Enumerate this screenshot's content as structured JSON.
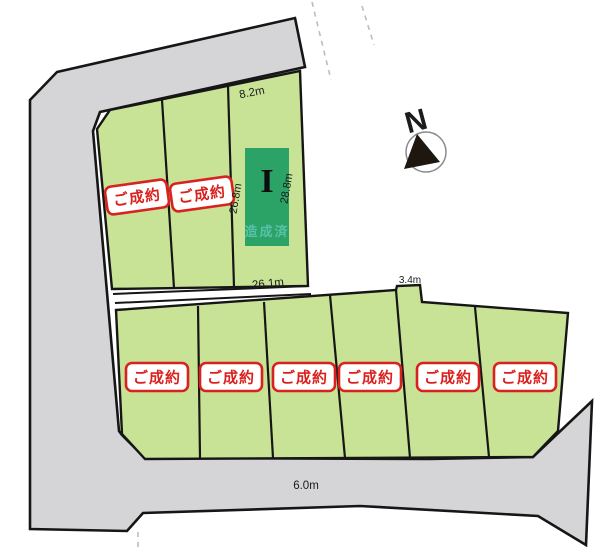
{
  "map_title": "分譲区画図",
  "compass": {
    "label": "N"
  },
  "dimensions": {
    "upper_top_width": "8.2m",
    "upper_left_depth": "26.8m",
    "upper_right_depth": "28.8m",
    "upper_bottom_width": "26.1m",
    "lower_notch_width": "3.4m",
    "road_width": "6.0m"
  },
  "plots": {
    "upper": [
      {
        "badge": "ご成約"
      },
      {
        "badge": "ご成約"
      },
      {
        "number": "I",
        "status": "造成済"
      }
    ],
    "lower": [
      {
        "badge": "ご成約"
      },
      {
        "badge": "ご成約"
      },
      {
        "badge": "ご成約"
      },
      {
        "badge": "ご成約"
      },
      {
        "badge": "ご成約"
      },
      {
        "badge": "ご成約"
      }
    ]
  },
  "colors": {
    "plot_green": "#c9e396",
    "reserved_lot_green": "#2ba266",
    "road_gray": "#d5d5d7",
    "badge_red": "#d9221f",
    "status_text_teal": "#57c2a8",
    "outline_black": "#161616"
  }
}
